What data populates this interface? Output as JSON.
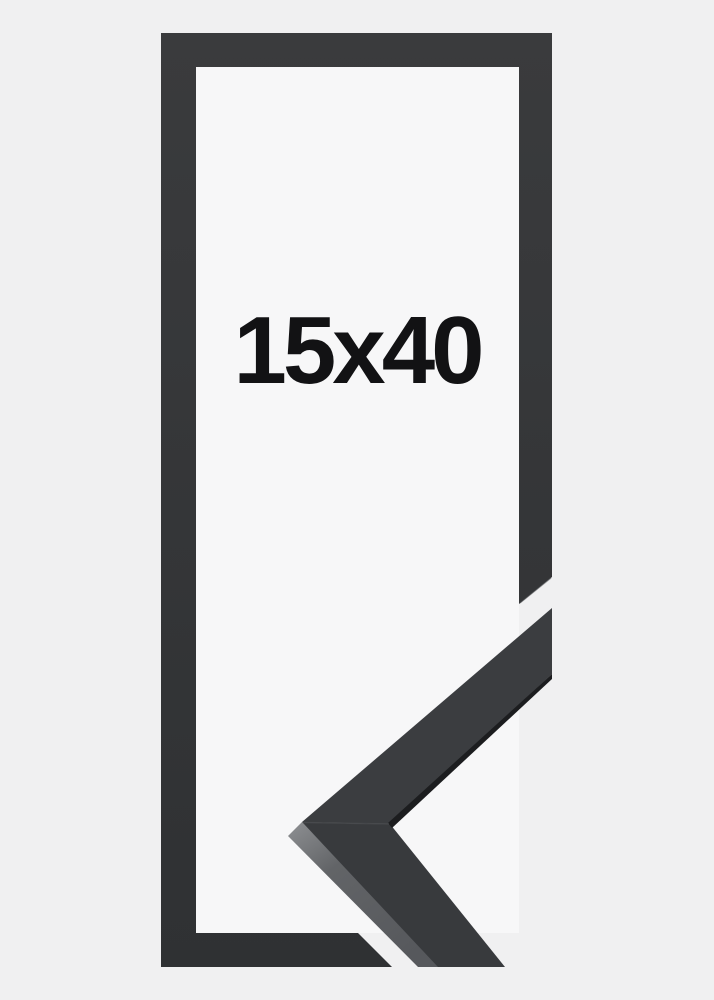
{
  "product_image": {
    "size_label": "15x40"
  },
  "colors": {
    "background_outer": "#f0f0f1",
    "background_inner": "#f7f7f8",
    "frame_gradient_top": "#3a3b3d",
    "frame_gradient_bottom": "#2f3133",
    "moulding_upper_face": "#3b3d40",
    "moulding_lower_face": "#383a3d",
    "moulding_underside": "#1c1d1f",
    "side_face_light": "#8e9093",
    "side_face_mid": "#626467",
    "side_face_dark": "#56585c",
    "mitre_seam": "#47494c",
    "cut_edge_highlight": "#4a4c4f",
    "label_text": "#121214"
  }
}
